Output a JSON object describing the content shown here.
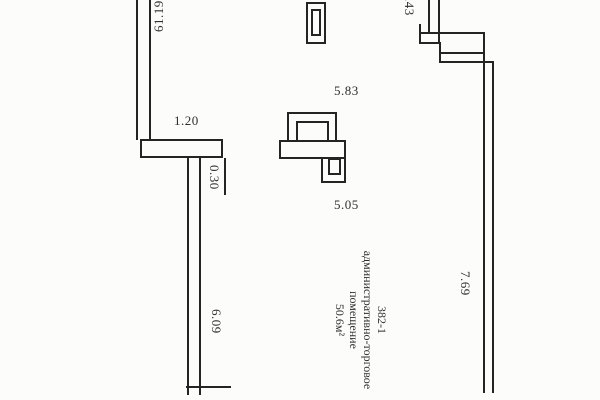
{
  "drawing": {
    "title": "floor-plan-fragment",
    "background_color": "#fcfcfb",
    "line_color": "#242424",
    "dims": {
      "wall_top_left": "61.19",
      "lintel_width": "1.20",
      "wall_thickness": "0.30",
      "wall_left_length": "6.09",
      "span_upper": "5.83",
      "span_lower": "5.05",
      "wall_top_right": "1.43",
      "wall_right_length": "7.69"
    },
    "room": {
      "number": "382-1",
      "name_line1": "административно-торговое",
      "name_line2": "помещение",
      "area": "50.6м²"
    }
  }
}
